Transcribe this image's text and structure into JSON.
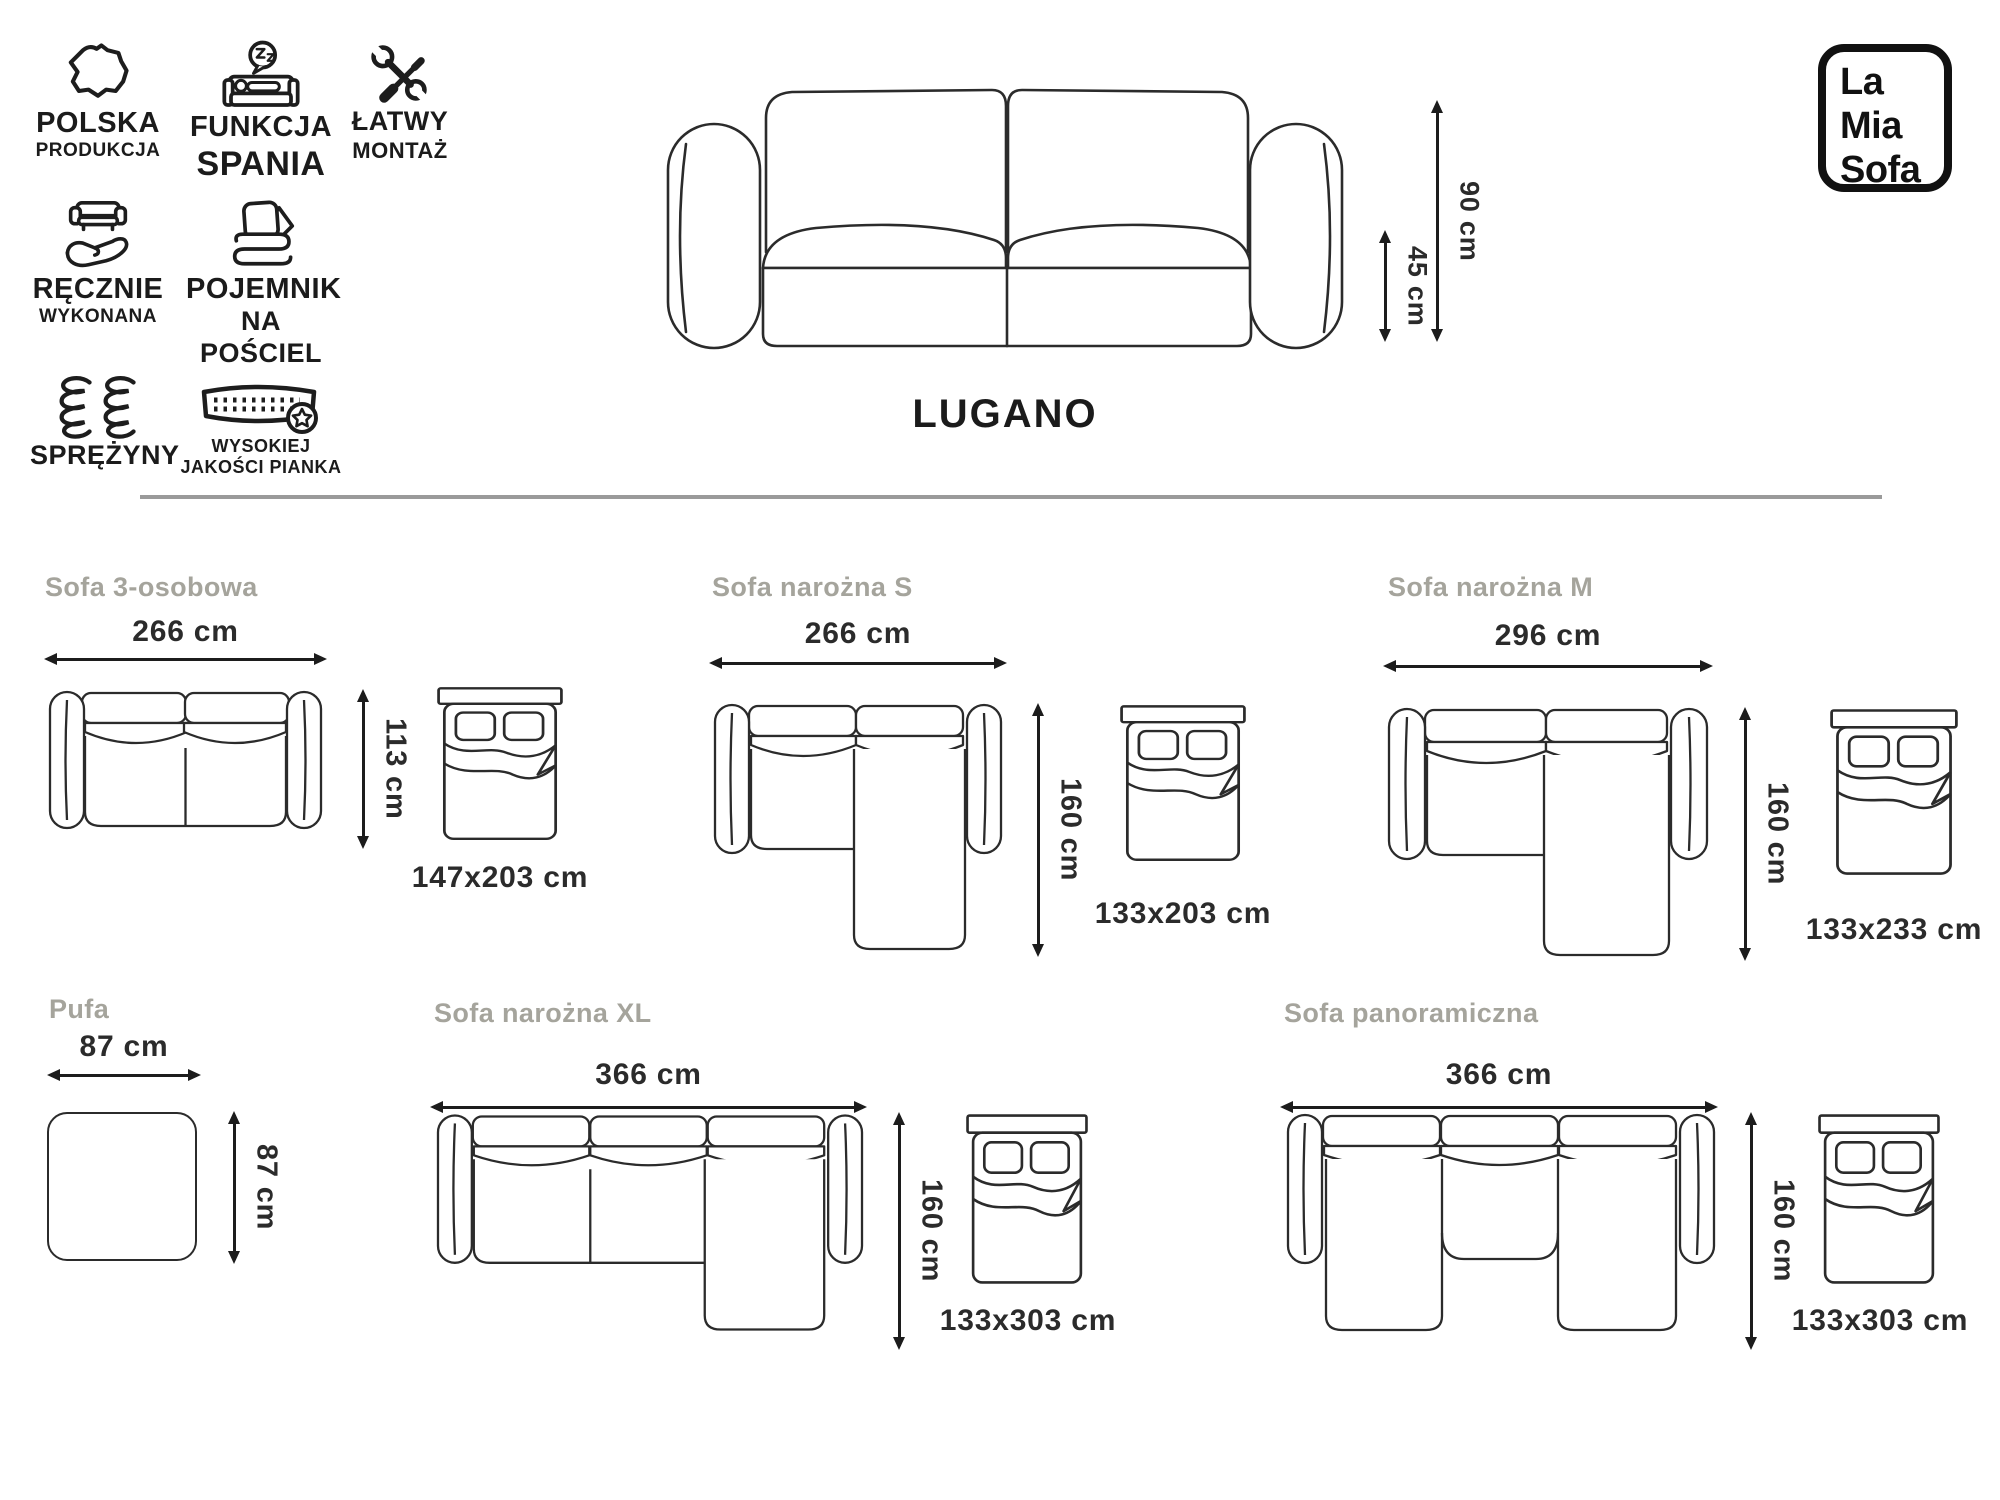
{
  "colors": {
    "line": "#262626",
    "muted_heading": "#a5a49c",
    "divider": "#9a9a9a",
    "text": "#1b1b1b"
  },
  "brand_logo": {
    "lines": [
      "La",
      "Mia",
      "Sofa"
    ]
  },
  "product": {
    "name": "LUGANO",
    "overall_height": "90 cm",
    "seat_height": "45 cm"
  },
  "features": [
    {
      "icon": "poland-map-icon",
      "line1": "POLSKA",
      "line2": "PRODUKCJA"
    },
    {
      "icon": "sleep-function-icon",
      "line1": "FUNKCJA",
      "line2": "SPANIA"
    },
    {
      "icon": "tools-icon",
      "line1": "ŁATWY",
      "line2": "MONTAŻ"
    },
    {
      "icon": "handmade-icon",
      "line1": "RĘCZNIE",
      "line2": "WYKONANA"
    },
    {
      "icon": "bedding-storage-icon",
      "line1": "POJEMNIK",
      "line2": "NA POŚCIEL"
    },
    {
      "icon": "springs-icon",
      "line1": "SPRĘŻYNY",
      "line2": ""
    },
    {
      "icon": "quality-foam-icon",
      "line1": "WYSOKIEJ",
      "line2": "JAKOŚCI PIANKA"
    }
  ],
  "sections": [
    {
      "title": "Sofa 3-osobowa",
      "width": "266 cm",
      "depth": "113 cm",
      "bed": "147x203 cm"
    },
    {
      "title": "Sofa narożna S",
      "width": "266 cm",
      "depth": "160 cm",
      "bed": "133x203 cm"
    },
    {
      "title": "Sofa narożna M",
      "width": "296 cm",
      "depth": "160 cm",
      "bed": "133x233 cm"
    },
    {
      "title": "Pufa",
      "width": "87 cm",
      "depth": "87 cm"
    },
    {
      "title": "Sofa narożna XL",
      "width": "366 cm",
      "depth": "160 cm",
      "bed": "133x303 cm"
    },
    {
      "title": "Sofa panoramiczna",
      "width": "366 cm",
      "depth": "160 cm",
      "bed": "133x303 cm"
    }
  ]
}
